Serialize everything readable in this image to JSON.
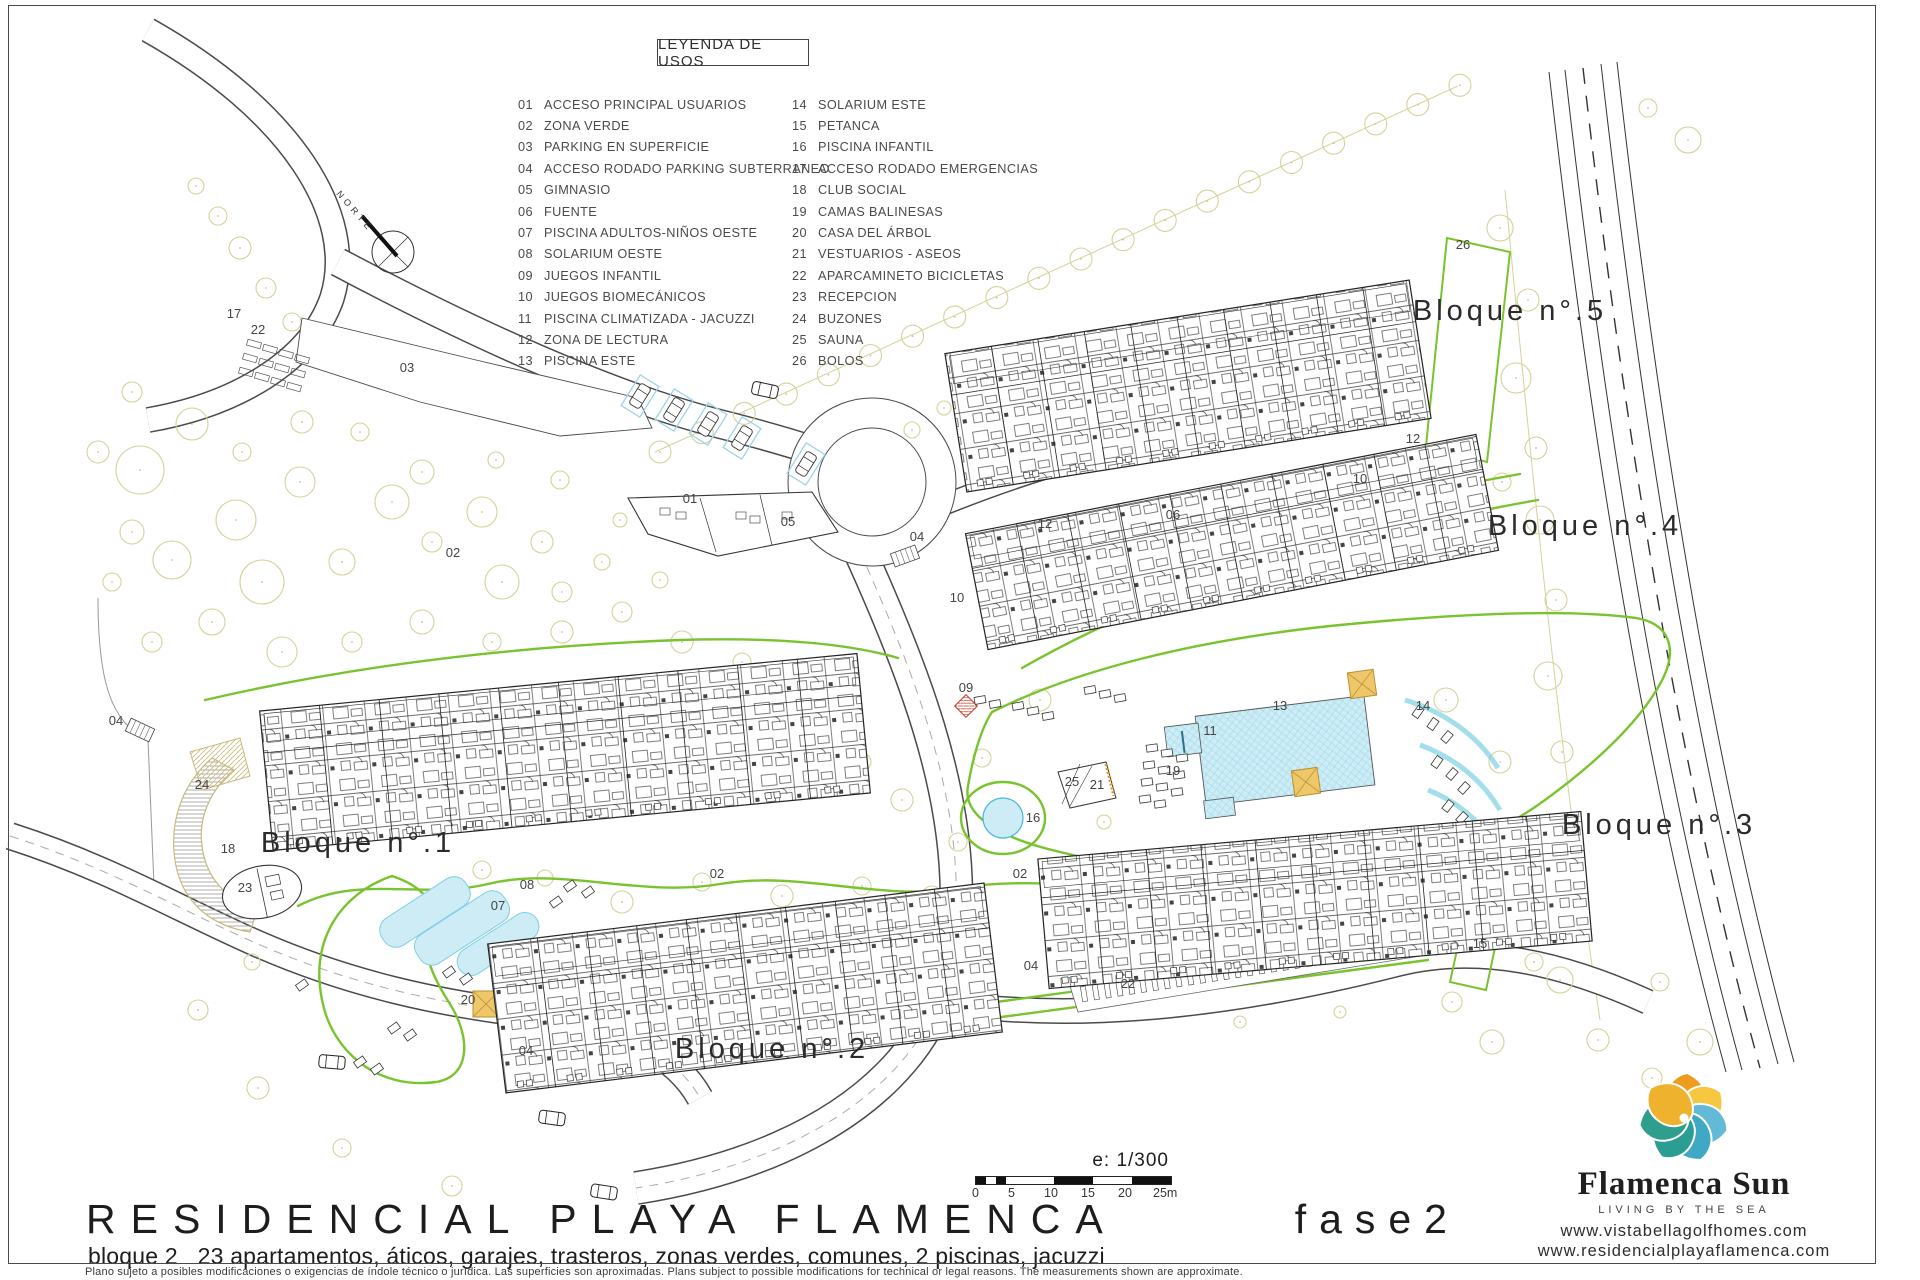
{
  "plan": {
    "north_label": "NORTE",
    "legend": {
      "title": "LEYENDA DE USOS",
      "items": [
        {
          "num": "01",
          "label": "ACCESO PRINCIPAL USUARIOS"
        },
        {
          "num": "02",
          "label": "ZONA VERDE"
        },
        {
          "num": "03",
          "label": "PARKING EN SUPERFICIE"
        },
        {
          "num": "04",
          "label": "ACCESO RODADO PARKING SUBTERRANEO"
        },
        {
          "num": "05",
          "label": "GIMNASIO"
        },
        {
          "num": "06",
          "label": "FUENTE"
        },
        {
          "num": "07",
          "label": "PISCINA ADULTOS-NIÑOS OESTE"
        },
        {
          "num": "08",
          "label": "SOLARIUM OESTE"
        },
        {
          "num": "09",
          "label": "JUEGOS INFANTIL"
        },
        {
          "num": "10",
          "label": "JUEGOS BIOMECÁNICOS"
        },
        {
          "num": "11",
          "label": "PISCINA CLIMATIZADA - JACUZZI"
        },
        {
          "num": "12",
          "label": "ZONA DE LECTURA"
        },
        {
          "num": "13",
          "label": "PISCINA ESTE"
        },
        {
          "num": "14",
          "label": "SOLARIUM ESTE"
        },
        {
          "num": "15",
          "label": "PETANCA"
        },
        {
          "num": "16",
          "label": "PISCINA INFANTIL"
        },
        {
          "num": "17",
          "label": "ACCESO RODADO EMERGENCIAS"
        },
        {
          "num": "18",
          "label": "CLUB SOCIAL"
        },
        {
          "num": "19",
          "label": "CAMAS BALINESAS"
        },
        {
          "num": "20",
          "label": "CASA DEL ÁRBOL"
        },
        {
          "num": "21",
          "label": "VESTUARIOS - ASEOS"
        },
        {
          "num": "22",
          "label": "APARCAMINETO BICICLETAS"
        },
        {
          "num": "23",
          "label": "RECEPCION"
        },
        {
          "num": "24",
          "label": "BUZONES"
        },
        {
          "num": "25",
          "label": "SAUNA"
        },
        {
          "num": "26",
          "label": "BOLOS"
        }
      ]
    },
    "block_labels": [
      {
        "t": "Bloque n°.1",
        "x": 358,
        "y": 852
      },
      {
        "t": "Bloque n°.2",
        "x": 772,
        "y": 1058
      },
      {
        "t": "Bloque n°.3",
        "x": 1659,
        "y": 834
      },
      {
        "t": "Bloque n°.4",
        "x": 1585,
        "y": 535
      },
      {
        "t": "Bloque n°.5",
        "x": 1510,
        "y": 320
      }
    ],
    "markers": [
      {
        "t": "17",
        "x": 234,
        "y": 318
      },
      {
        "t": "22",
        "x": 258,
        "y": 334
      },
      {
        "t": "03",
        "x": 407,
        "y": 372
      },
      {
        "t": "02",
        "x": 453,
        "y": 557
      },
      {
        "t": "01",
        "x": 690,
        "y": 503
      },
      {
        "t": "05",
        "x": 788,
        "y": 526
      },
      {
        "t": "04",
        "x": 917,
        "y": 541
      },
      {
        "t": "06",
        "x": 1173,
        "y": 519
      },
      {
        "t": "12",
        "x": 1045,
        "y": 528
      },
      {
        "t": "10",
        "x": 1360,
        "y": 483
      },
      {
        "t": "12",
        "x": 1413,
        "y": 443
      },
      {
        "t": "09",
        "x": 966,
        "y": 692
      },
      {
        "t": "10",
        "x": 957,
        "y": 602
      },
      {
        "t": "11",
        "x": 1210,
        "y": 735
      },
      {
        "t": "13",
        "x": 1280,
        "y": 710
      },
      {
        "t": "19",
        "x": 1173,
        "y": 775
      },
      {
        "t": "25",
        "x": 1072,
        "y": 786
      },
      {
        "t": "21",
        "x": 1097,
        "y": 789
      },
      {
        "t": "16",
        "x": 1033,
        "y": 822
      },
      {
        "t": "14",
        "x": 1423,
        "y": 710
      },
      {
        "t": "18",
        "x": 228,
        "y": 853
      },
      {
        "t": "23",
        "x": 245,
        "y": 892
      },
      {
        "t": "24",
        "x": 202,
        "y": 789
      },
      {
        "t": "20",
        "x": 468,
        "y": 1004
      },
      {
        "t": "26",
        "x": 1463,
        "y": 249
      },
      {
        "t": "15",
        "x": 1480,
        "y": 948
      },
      {
        "t": "22",
        "x": 1128,
        "y": 988
      },
      {
        "t": "07",
        "x": 498,
        "y": 910
      },
      {
        "t": "08",
        "x": 527,
        "y": 889
      },
      {
        "t": "02",
        "x": 717,
        "y": 878
      },
      {
        "t": "02",
        "x": 1020,
        "y": 878
      },
      {
        "t": "04",
        "x": 526,
        "y": 1055
      },
      {
        "t": "04",
        "x": 116,
        "y": 725
      },
      {
        "t": "04",
        "x": 1031,
        "y": 970
      }
    ]
  },
  "titleblock": {
    "project": "RESIDENCIAL PLAYA FLAMENCA",
    "phase": "fase2",
    "subtitle": "bloque 2   23 apartamentos, áticos, garajes, trasteros, zonas verdes, comunes, 2 piscinas, jacuzzi",
    "scale_label": "e: 1/300",
    "scale_ticks": [
      "0",
      "5",
      "10",
      "15",
      "20",
      "25m"
    ],
    "disclaimer": "Plano sujeto a posibles modificaciones o exigencias de índole técnico o jurídica. Las superficies son aproximadas. Plans subject to possible modifications for technical or legal reasons. The measurements shown are approximate."
  },
  "brand": {
    "name": "Flamenca Sun",
    "tagline": "LIVING BY THE SEA",
    "website1": "www.vistabellagolfhomes.com",
    "website2": "www.residencialplayaflamenca.com",
    "petal_colors": [
      "#EE9B1E",
      "#F5C840",
      "#63B9D8",
      "#3FA8C5",
      "#2B9D92",
      "#2F9E8C",
      "#EFB22F"
    ]
  },
  "colors": {
    "green": "#79C32F",
    "tree": "#D6D199",
    "pool_fill": "#CDECF5",
    "pool_stroke": "#45B8D6",
    "tan_fill": "#EEC76A",
    "tan_stroke": "#B9902E",
    "line": "#3A3A3A"
  }
}
